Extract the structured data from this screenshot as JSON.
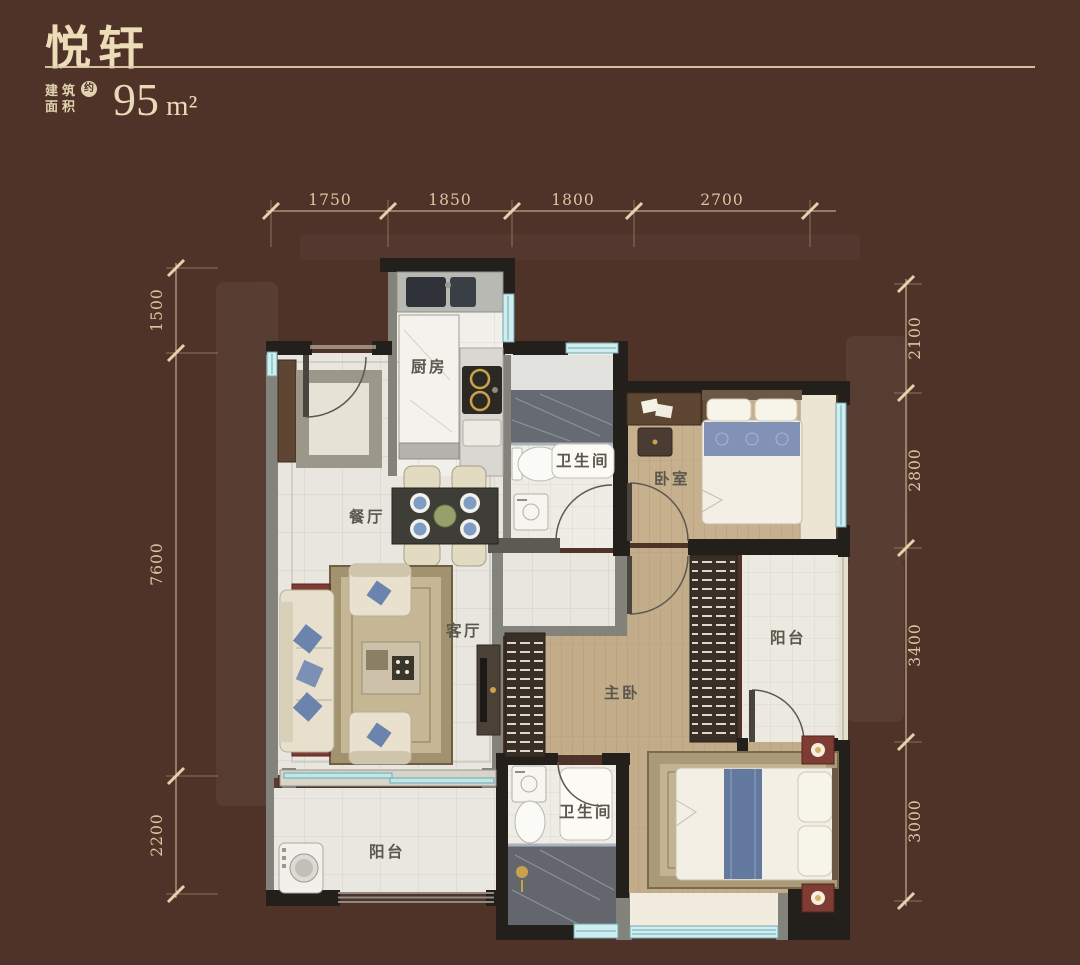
{
  "header": {
    "title": "悦轩",
    "area_label_line1": "建筑",
    "area_label_line2": "面积",
    "approx_badge": "约",
    "area_value": "95",
    "area_unit": "m²"
  },
  "dimensions": {
    "top": [
      "1750",
      "1850",
      "1800",
      "2700"
    ],
    "left": [
      "1500",
      "7600",
      "2200"
    ],
    "right": [
      "2100",
      "2800",
      "3400",
      "3000"
    ]
  },
  "rooms": {
    "kitchen": {
      "label": "厨房"
    },
    "dining": {
      "label": "餐厅"
    },
    "living": {
      "label": "客厅"
    },
    "bath_top": {
      "label": "卫生间"
    },
    "bedroom": {
      "label": "卧室"
    },
    "master": {
      "label": "主卧"
    },
    "balcony_right": {
      "label": "阳台"
    },
    "bath_bottom": {
      "label": "卫生间"
    },
    "balcony_left": {
      "label": "阳台"
    }
  },
  "colors": {
    "background": "#4f3228",
    "cream_text": "#e6d5b2",
    "wall_dark": "#23201c",
    "wall_gray": "#83827b",
    "window_glass": "#cfeef1",
    "floor_tile": "#e8e6de",
    "floor_wood": "#c3ac89",
    "shower_dark": "#63666d",
    "wardrobe": "#3a2f27",
    "accent_red": "#7e3c33",
    "accent_blue": "#6b84ad",
    "room_label": "#5a574c"
  }
}
